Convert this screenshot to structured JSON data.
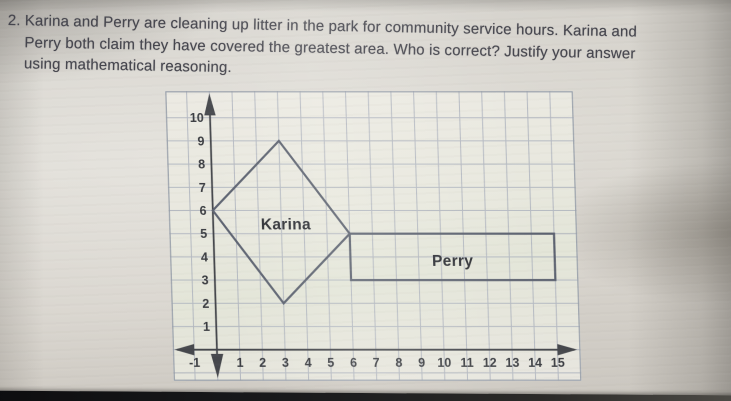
{
  "problem": {
    "number": "2.",
    "lines": [
      "Karina and Perry are cleaning up litter in the park for community service hours. Karina and",
      "Perry both claim they have covered the greatest area. Who is correct? Justify your answer",
      "using mathematical reasoning."
    ]
  },
  "graph": {
    "x_ticks": [
      -1,
      1,
      2,
      3,
      4,
      5,
      6,
      7,
      8,
      9,
      10,
      11,
      12,
      13,
      14,
      15
    ],
    "y_ticks": [
      1,
      2,
      3,
      4,
      5,
      6,
      7,
      8,
      9,
      10
    ],
    "grid": {
      "x_min": -1,
      "x_max": 15,
      "y_min": -1,
      "y_max": 10
    },
    "shapes": [
      {
        "id": "karina",
        "type": "polygon",
        "vertices": [
          [
            0,
            6
          ],
          [
            3,
            9
          ],
          [
            6,
            5
          ],
          [
            3,
            2
          ]
        ],
        "label": "Karina",
        "label_x": 3.2,
        "label_y": 5.4
      },
      {
        "id": "perry",
        "type": "rect",
        "x1": 6,
        "y1": 3,
        "x2": 15,
        "y2": 5,
        "label": "Perry",
        "label_x": 10.5,
        "label_y": 3.82
      }
    ],
    "colors": {
      "grid": "#a8aebb",
      "border": "#99a0ab",
      "axis": "#45474c",
      "shape": "#5c6270",
      "tick": "#3a3c41",
      "label": "#2c2e34"
    }
  }
}
